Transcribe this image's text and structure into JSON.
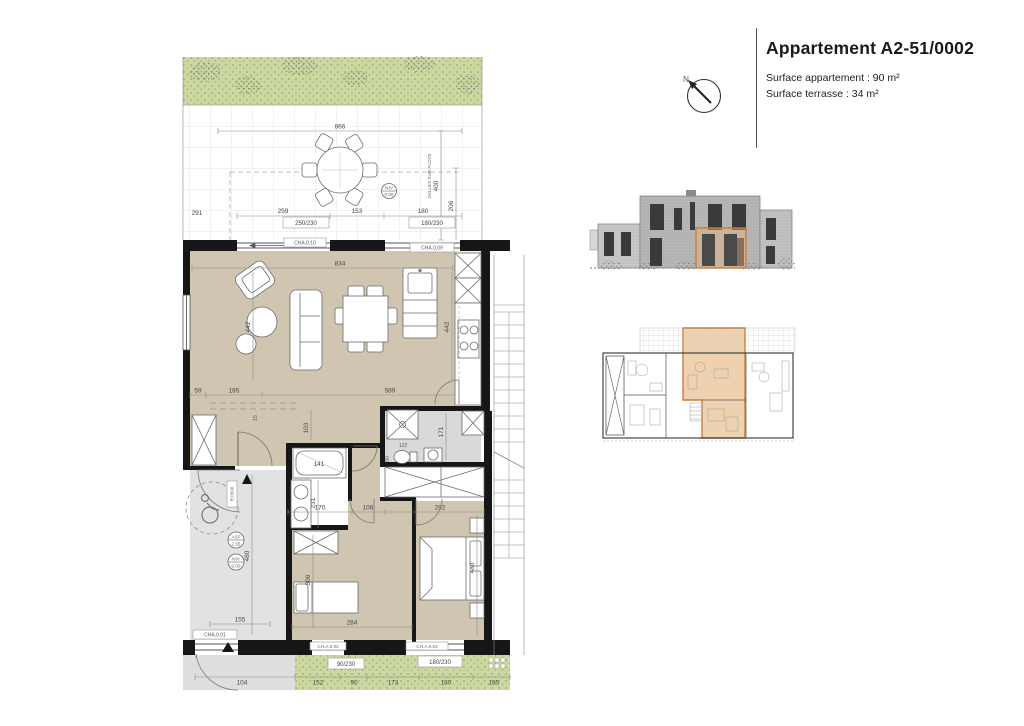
{
  "header": {
    "title": "Appartement A2-51/0002",
    "surface_apartment": "Surface appartement : 90 m²",
    "surface_terrace": "Surface terrasse : 34 m²",
    "north": "N"
  },
  "colors": {
    "wall": "#161616",
    "floor": "#cfc5b1",
    "floor_grey": "#d9d9d9",
    "vestibule": "#e2e2e2",
    "green": "#cbd89f",
    "kitchen": "#f1efe9",
    "accent": "#c97f3d",
    "highlight": "#eed2b0",
    "elev_highlight": "#e9b27c"
  },
  "plan": {
    "terrace": {
      "d866": "866",
      "d291": "291",
      "d259": "259",
      "d153": "153",
      "d180": "180",
      "d400": "400",
      "d206": "206",
      "note": "DALLES SUR PLOTS",
      "lvl_top": "NIV",
      "lvl_bot": "0.00"
    },
    "top_windows": {
      "w250": "250/230",
      "w180": "180/230",
      "cha10": "CHA.0.10",
      "cha09": "CHA.0.09"
    },
    "living": {
      "d834": "834",
      "d442": "442",
      "d59": "59",
      "d185": "185",
      "d589": "589"
    },
    "hall": {
      "d103": "103",
      "d15": "15"
    },
    "bath": {
      "d141": "141",
      "d231": "231",
      "d170": "170",
      "d106": "106"
    },
    "wc": {
      "d122": "122",
      "d80": "80",
      "d171": "171"
    },
    "bed1": {
      "d309": "309",
      "d284": "284"
    },
    "bed2": {
      "d292": "292",
      "d480": "480"
    },
    "entry": {
      "d155": "155",
      "d480": "480",
      "d104": "104",
      "door_ref": "R.0500",
      "lvl1_top": "ASP",
      "lvl1_bot": "2.55",
      "lvl2_top": "NIV",
      "lvl2_bot": "0.00",
      "cha01": "CHA.0.01"
    },
    "bottom": {
      "d152": "152",
      "d90": "90",
      "d173": "173",
      "d180": "180",
      "d185": "185",
      "w90": "90/230",
      "w180": "180/230",
      "cha02": "CH.A.0.02",
      "cha03": "CH.A.0.03"
    }
  }
}
